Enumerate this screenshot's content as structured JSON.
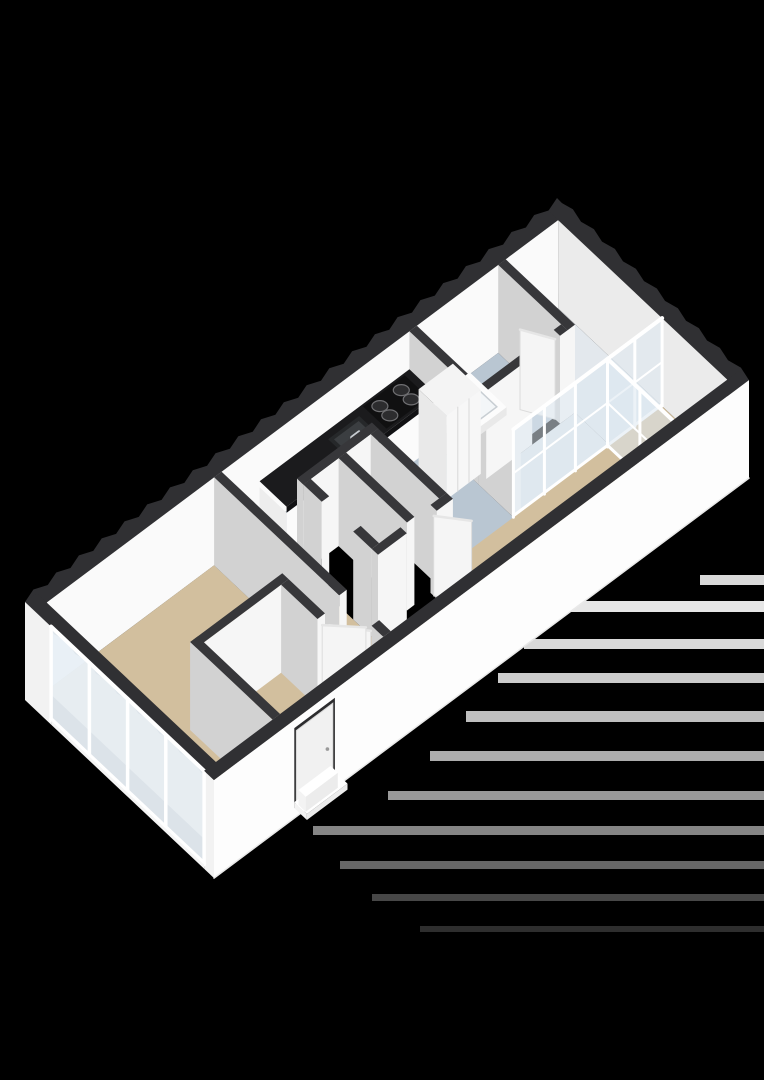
{
  "meta": {
    "canvas_w": 764,
    "canvas_h": 1080,
    "background": "#000000",
    "view": "isometric-3d-floorplan"
  },
  "projection": {
    "ox": 25,
    "oy": 690,
    "ux": 0.535,
    "uy": -0.4,
    "vx": 0.45,
    "vy": 0.424,
    "wall_h": 88,
    "slab": 10
  },
  "palette": {
    "wall_top": "#37373a",
    "ext_wall_top": "#303033",
    "face_se": "#f6f6f6",
    "face_sw": "#d2d2d2",
    "face_inner_nw": "#fafafa",
    "face_inner_ne": "#ebebeb",
    "ext_face": "#fdfdfd",
    "ext_face_sw": "#f2f2f2",
    "floor_tan": "#d2bf9e",
    "floor_blue": "#b9c6d2",
    "floor_pale": "#e3e8ed",
    "floor_mat": "#c9b893",
    "glass": "#dce8f0",
    "glass_ext": "#e8eff5",
    "frame": "#ffffff",
    "leaf": "#f5f5f5",
    "leaf_edge": "#dcdcdc",
    "counter_top": "#1b1b1d",
    "counter_body": "#fbfbfb",
    "cooktop": "#101011",
    "burner": "#2c2c2e",
    "burner_ring": "#6f6f72",
    "sink_outer": "#26282a",
    "sink_inner": "#3b3e41",
    "steel": "#c6cbd0",
    "shower_top": "#fcfcfc",
    "shower_inner": "#f3f6f8",
    "shower_line": "#c8ced3",
    "shadow_band": "#ffffff"
  },
  "plan": {
    "length": 1000,
    "width": 420,
    "ext_t": 22
  },
  "floors": [
    {
      "name": "floor-bedroom",
      "rect": [
        22,
        22,
        335,
        398
      ],
      "color": "floor_tan"
    },
    {
      "name": "floor-corridor",
      "rect": [
        335,
        105,
        420,
        398
      ],
      "color": "floor_tan"
    },
    {
      "name": "floor-living-south",
      "rect": [
        420,
        285,
        560,
        398
      ],
      "color": "floor_tan"
    },
    {
      "name": "floor-living-main",
      "rect": [
        560,
        250,
        876,
        398
      ],
      "color": "floor_tan"
    },
    {
      "name": "floor-loggia",
      "rect": [
        876,
        253,
        978,
        398
      ],
      "color": "floor_tan"
    },
    {
      "name": "floor-kitchen-a",
      "rect": [
        335,
        22,
        700,
        105
      ],
      "color": "floor_blue"
    },
    {
      "name": "floor-kitchen-b",
      "rect": [
        560,
        105,
        700,
        253
      ],
      "color": "floor_blue"
    },
    {
      "name": "floor-bathroom",
      "rect": [
        714,
        22,
        866,
        162
      ],
      "color": "floor_blue"
    },
    {
      "name": "floor-hall-ne-a",
      "rect": [
        880,
        22,
        978,
        253
      ],
      "color": "floor_pale"
    },
    {
      "name": "floor-hall-ne-b",
      "rect": [
        714,
        176,
        880,
        253
      ],
      "color": "floor_pale"
    },
    {
      "name": "floor-entry-mat",
      "rect": [
        150,
        320,
        224,
        392
      ],
      "color": "floor_mat"
    }
  ],
  "interior_walls": [
    {
      "name": "wall-bedroom-a",
      "rect": [
        335,
        22,
        349,
        300
      ]
    },
    {
      "name": "wall-bedroom-b",
      "rect": [
        335,
        372,
        349,
        398
      ]
    },
    {
      "name": "wall-wc-nw",
      "rect": [
        420,
        105,
        560,
        119
      ]
    },
    {
      "name": "wall-wc-sw-a",
      "rect": [
        420,
        119,
        434,
        160
      ]
    },
    {
      "name": "wall-wc-sw-b",
      "rect": [
        420,
        230,
        434,
        271
      ]
    },
    {
      "name": "wall-wc-se-a",
      "rect": [
        420,
        271,
        474,
        285
      ]
    },
    {
      "name": "wall-wc-se-b",
      "rect": [
        530,
        271,
        560,
        285
      ]
    },
    {
      "name": "wall-wc-ne",
      "rect": [
        546,
        119,
        560,
        271
      ]
    },
    {
      "name": "wall-wc-divider",
      "rect": [
        486,
        119,
        500,
        271
      ]
    },
    {
      "name": "wall-kitchen-bath-a",
      "rect": [
        700,
        22,
        714,
        176
      ]
    },
    {
      "name": "wall-kitchen-bath-b",
      "rect": [
        700,
        176,
        714,
        253
      ]
    },
    {
      "name": "wall-bath-se-a",
      "rect": [
        714,
        162,
        800,
        176
      ]
    },
    {
      "name": "wall-bath-se-b",
      "rect": [
        852,
        162,
        866,
        176
      ]
    },
    {
      "name": "wall-bath-ne",
      "rect": [
        866,
        22,
        880,
        176
      ]
    },
    {
      "name": "wall-vestibule-sw",
      "rect": [
        128,
        215,
        142,
        398
      ]
    },
    {
      "name": "wall-vestibule-nw",
      "rect": [
        128,
        215,
        300,
        229
      ]
    },
    {
      "name": "wall-vestibule-ne-a",
      "rect": [
        286,
        229,
        300,
        310
      ]
    },
    {
      "name": "wall-vestibule-ne-b",
      "rect": [
        286,
        375,
        300,
        398
      ]
    }
  ],
  "door_leaves": [
    {
      "name": "door-leaf-bedroom",
      "from": [
        335,
        370
      ],
      "to": [
        298,
        322
      ],
      "h": 82
    },
    {
      "name": "door-leaf-wc",
      "from": [
        530,
        278
      ],
      "to": [
        564,
        322
      ],
      "h": 80
    },
    {
      "name": "door-leaf-bathroom",
      "from": [
        852,
        165
      ],
      "to": [
        826,
        118
      ],
      "h": 80
    },
    {
      "name": "door-leaf-vestibule",
      "from": [
        293,
        312
      ],
      "to": [
        336,
        358
      ],
      "h": 80
    }
  ],
  "glass_walls": [
    {
      "name": "glass-sliding-door-living",
      "axis": "u",
      "fixed": 253,
      "from": 700,
      "to": 978,
      "posts": [
        700,
        758,
        816,
        876,
        927,
        978
      ],
      "top": 88,
      "bottom": 0,
      "midrail": true
    },
    {
      "name": "glass-partition-loggia",
      "axis": "v",
      "fixed": 876,
      "from": 253,
      "to": 398,
      "posts": [
        253,
        325,
        398
      ],
      "top": 88,
      "bottom": 0,
      "midrail": true
    }
  ],
  "exterior_glazing": {
    "name": "window-wall-sw",
    "u": 0,
    "from": 58,
    "to": 398,
    "posts": [
      58,
      143,
      228,
      313,
      398
    ],
    "top": 88,
    "bottom": -6
  },
  "kitchen": {
    "counter": {
      "name": "kitchen-counter",
      "rect": [
        420,
        22,
        700,
        82
      ],
      "body_h": 44,
      "top_h": 50
    },
    "cooktop": {
      "name": "cooktop",
      "rect": [
        610,
        26,
        688,
        78
      ],
      "h": 50.5,
      "burners": [
        [
          628,
          42
        ],
        [
          628,
          64
        ],
        [
          668,
          42
        ],
        [
          668,
          64
        ]
      ],
      "rx": 8,
      "ry": 5.5
    },
    "sink": {
      "name": "kitchen-sink",
      "outer": [
        538,
        34,
        596,
        76
      ],
      "inner": [
        544,
        40,
        590,
        70
      ],
      "h": 50
    },
    "faucet": {
      "name": "sink-faucet",
      "u": 548,
      "v": 74,
      "h0": 50,
      "h1": 65,
      "u2": 562
    },
    "tall_cabinet": {
      "name": "kitchen-tall-cabinet",
      "rect": [
        650,
        102,
        714,
        164
      ],
      "h": 84,
      "seams": [
        671,
        692
      ]
    }
  },
  "bathroom": {
    "shower": {
      "name": "shower-tray",
      "rect": [
        724,
        30,
        806,
        112
      ],
      "h": 8,
      "inset": 10,
      "drain": [
        765,
        71
      ]
    }
  },
  "entry": {
    "door_recess": {
      "name": "front-door-recess",
      "u1": 150,
      "u2": 226,
      "h": 80
    },
    "door_leaf": {
      "name": "front-door",
      "u1": 154,
      "u2": 222,
      "h": 76
    },
    "steps": [
      {
        "name": "entry-step-lower",
        "rect": [
          150,
          420,
          226,
          448
        ],
        "h": 6
      },
      {
        "name": "entry-step-upper",
        "rect": [
          158,
          420,
          218,
          436
        ],
        "h": 15
      }
    ]
  },
  "shadow_bands": [
    {
      "x": 700,
      "y": 575,
      "w": 64,
      "h": 10,
      "o": 0.85
    },
    {
      "x": 560,
      "y": 601,
      "w": 204,
      "h": 11,
      "o": 0.9
    },
    {
      "x": 524,
      "y": 639,
      "w": 240,
      "h": 10,
      "o": 0.85
    },
    {
      "x": 498,
      "y": 673,
      "w": 266,
      "h": 10,
      "o": 0.8
    },
    {
      "x": 466,
      "y": 711,
      "w": 298,
      "h": 11,
      "o": 0.75
    },
    {
      "x": 430,
      "y": 751,
      "w": 334,
      "h": 10,
      "o": 0.68
    },
    {
      "x": 388,
      "y": 791,
      "w": 376,
      "h": 9,
      "o": 0.6
    },
    {
      "x": 313,
      "y": 826,
      "w": 451,
      "h": 9,
      "o": 0.52
    },
    {
      "x": 340,
      "y": 861,
      "w": 424,
      "h": 8,
      "o": 0.4
    },
    {
      "x": 372,
      "y": 894,
      "w": 392,
      "h": 7,
      "o": 0.28
    },
    {
      "x": 420,
      "y": 926,
      "w": 344,
      "h": 6,
      "o": 0.18
    }
  ],
  "teeth": {
    "nw_amp": 5,
    "sw_amp": 3.5,
    "ne_amp": 3.5,
    "step": 14
  }
}
